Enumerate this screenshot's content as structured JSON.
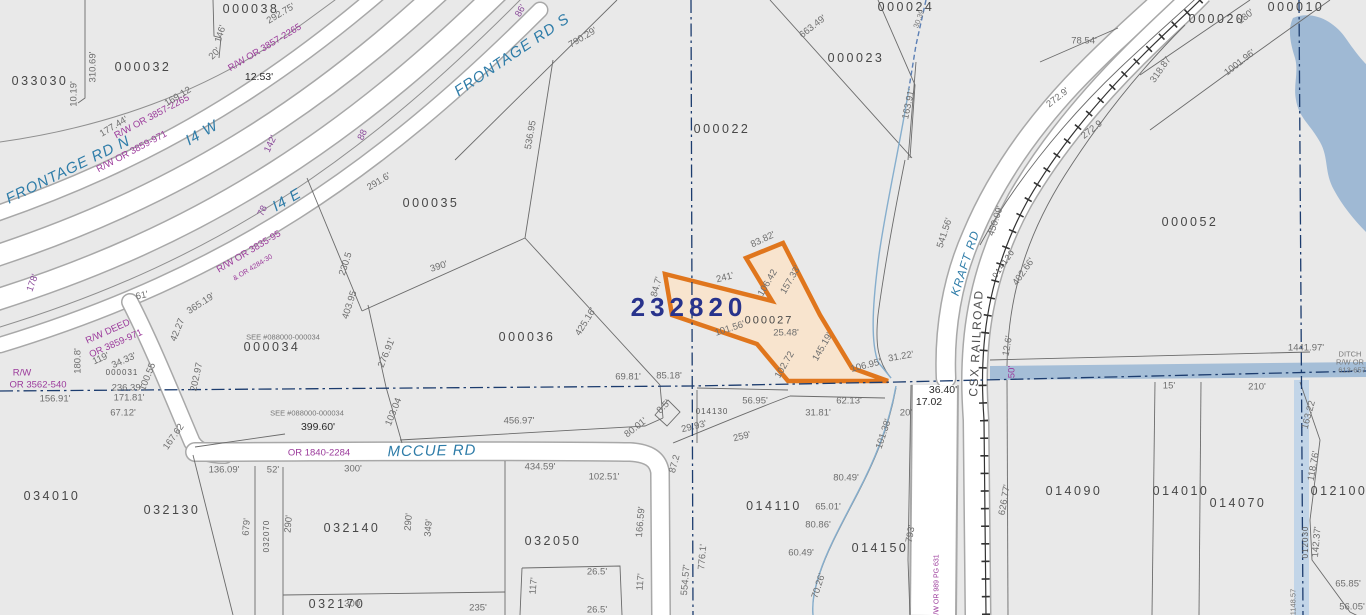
{
  "map": {
    "type": "county-parcel-gis-map",
    "highlight": {
      "id": "232820",
      "parcel": "000027",
      "outline_color": "#e0761d",
      "fill_color": "#f8e4ce"
    },
    "colors": {
      "parcel_fill": "#e9e9e9",
      "road_fill": "#ffffff",
      "road_casing": "#a8a8a8",
      "boundary": "#6b6b6b",
      "section_line": "#1c3c6e",
      "water": "#9fb9d4",
      "stream": "#86aecd",
      "parcel_text": "#474747",
      "dim_text": "#6e6e6e",
      "record_text": "#9b3a9b",
      "road_text": "#2e7ca8",
      "highlight_id_text": "#28338c"
    },
    "roads": [
      "FRONTAGE RD N",
      "I4 W",
      "I4 E",
      "FRONTAGE RD S",
      "MCCUE RD",
      "KRAFT RD"
    ],
    "railroad": "CSX RAILROAD",
    "water_features": [
      "pond",
      "DITCH R/W OR 613-657",
      "stream"
    ]
  },
  "labels": [
    {
      "text": "033030",
      "x": 40,
      "y": 81,
      "r": 0,
      "c": "p"
    },
    {
      "text": "000032",
      "x": 143,
      "y": 67,
      "r": 0,
      "c": "p"
    },
    {
      "text": "000038",
      "x": 251,
      "y": 9,
      "r": 0,
      "c": "p"
    },
    {
      "text": "000035",
      "x": 431,
      "y": 203,
      "r": 0,
      "c": "p"
    },
    {
      "text": "000036",
      "x": 527,
      "y": 337,
      "r": 0,
      "c": "p"
    },
    {
      "text": "000034",
      "x": 272,
      "y": 347,
      "r": 0,
      "c": "p"
    },
    {
      "text": "034010",
      "x": 52,
      "y": 496,
      "r": 0,
      "c": "p"
    },
    {
      "text": "032130",
      "x": 172,
      "y": 510,
      "r": 0,
      "c": "p"
    },
    {
      "text": "032140",
      "x": 352,
      "y": 528,
      "r": 0,
      "c": "p"
    },
    {
      "text": "032050",
      "x": 553,
      "y": 541,
      "r": 0,
      "c": "p"
    },
    {
      "text": "032170",
      "x": 337,
      "y": 604,
      "r": 0,
      "c": "p"
    },
    {
      "text": "000022",
      "x": 722,
      "y": 129,
      "r": 0,
      "c": "p"
    },
    {
      "text": "000023",
      "x": 856,
      "y": 58,
      "r": 0,
      "c": "p"
    },
    {
      "text": "000024",
      "x": 906,
      "y": 7,
      "r": 0,
      "c": "p"
    },
    {
      "text": "000052",
      "x": 1190,
      "y": 222,
      "r": 0,
      "c": "p"
    },
    {
      "text": "000020",
      "x": 1217,
      "y": 19,
      "r": 0,
      "c": "p"
    },
    {
      "text": "000010",
      "x": 1296,
      "y": 7,
      "r": 0,
      "c": "p"
    },
    {
      "text": "014110",
      "x": 774,
      "y": 506,
      "r": 0,
      "c": "p"
    },
    {
      "text": "014150",
      "x": 880,
      "y": 548,
      "r": 0,
      "c": "p"
    },
    {
      "text": "014090",
      "x": 1074,
      "y": 491,
      "r": 0,
      "c": "p"
    },
    {
      "text": "014010",
      "x": 1181,
      "y": 491,
      "r": 0,
      "c": "p"
    },
    {
      "text": "014070",
      "x": 1238,
      "y": 503,
      "r": 0,
      "c": "p"
    },
    {
      "text": "012100",
      "x": 1339,
      "y": 491,
      "r": 0,
      "c": "p"
    },
    {
      "text": "000027",
      "x": 769,
      "y": 321,
      "r": 0,
      "c": "pm"
    },
    {
      "text": "014130",
      "x": 712,
      "y": 412,
      "r": 0,
      "c": "ps"
    },
    {
      "text": "000031",
      "x": 122,
      "y": 373,
      "r": 0,
      "c": "ps"
    },
    {
      "text": "032070",
      "x": 267,
      "y": 536,
      "r": -90,
      "c": "ps"
    },
    {
      "text": "012030",
      "x": 1306,
      "y": 542,
      "r": -90,
      "c": "ps"
    },
    {
      "text": "014120",
      "x": 1004,
      "y": 264,
      "r": -55,
      "c": "ps"
    },
    {
      "text": "232820",
      "x": 689,
      "y": 307,
      "r": 0,
      "c": "big"
    },
    {
      "text": "FRONTAGE RD N",
      "x": 68,
      "y": 170,
      "r": -26,
      "c": "road"
    },
    {
      "text": "FRONTAGE RD S",
      "x": 512,
      "y": 55,
      "r": -34,
      "c": "road"
    },
    {
      "text": "I4 W",
      "x": 202,
      "y": 133,
      "r": -30,
      "c": "road"
    },
    {
      "text": "I4 E",
      "x": 287,
      "y": 200,
      "r": -30,
      "c": "road"
    },
    {
      "text": "MCCUE RD",
      "x": 432,
      "y": 451,
      "r": -1,
      "c": "road"
    },
    {
      "text": "KRAFT RD",
      "x": 965,
      "y": 263,
      "r": -72,
      "c": "roads"
    },
    {
      "text": "CSX RAILROAD",
      "x": 976,
      "y": 343,
      "r": -87,
      "c": "rr"
    },
    {
      "text": "R/W OR 3857-2265",
      "x": 265,
      "y": 48,
      "r": -31,
      "c": "rw"
    },
    {
      "text": "R/W OR 3857-2265",
      "x": 152,
      "y": 117,
      "r": -28,
      "c": "rw"
    },
    {
      "text": "R/W OR 3859-971",
      "x": 132,
      "y": 152,
      "r": -28,
      "c": "rw"
    },
    {
      "text": "R/W OR 3835-95",
      "x": 249,
      "y": 252,
      "r": -31,
      "c": "rw"
    },
    {
      "text": "& OR 4284-30",
      "x": 253,
      "y": 268,
      "r": -31,
      "c": "rws"
    },
    {
      "text": "R/W DEED",
      "x": 108,
      "y": 332,
      "r": -24,
      "c": "rw"
    },
    {
      "text": "OR 3859-971",
      "x": 116,
      "y": 344,
      "r": -24,
      "c": "rw"
    },
    {
      "text": "R/W",
      "x": 22,
      "y": 373,
      "r": 0,
      "c": "rw"
    },
    {
      "text": "OR 3562-540",
      "x": 38,
      "y": 385,
      "r": 0,
      "c": "rw"
    },
    {
      "text": "OR 1840-2284",
      "x": 319,
      "y": 453,
      "r": 0,
      "c": "rw"
    },
    {
      "text": "R/W OR 989 PG 631",
      "x": 937,
      "y": 587,
      "r": -90,
      "c": "rws"
    },
    {
      "text": "50'",
      "x": 1012,
      "y": 372,
      "r": -90,
      "c": "rw"
    },
    {
      "text": "142'",
      "x": 271,
      "y": 144,
      "r": -65,
      "c": "pu"
    },
    {
      "text": "88",
      "x": 363,
      "y": 135,
      "r": -65,
      "c": "pu"
    },
    {
      "text": "78",
      "x": 263,
      "y": 211,
      "r": -65,
      "c": "pu"
    },
    {
      "text": "178'",
      "x": 33,
      "y": 283,
      "r": -70,
      "c": "pu"
    },
    {
      "text": "86'",
      "x": 521,
      "y": 11,
      "r": -60,
      "c": "pu"
    },
    {
      "text": "12.53'",
      "x": 259,
      "y": 77,
      "r": 0,
      "c": "dk"
    },
    {
      "text": "36.40'",
      "x": 943,
      "y": 390,
      "r": 0,
      "c": "dk"
    },
    {
      "text": "17.02",
      "x": 929,
      "y": 402,
      "r": 0,
      "c": "dk"
    },
    {
      "text": "292.75'",
      "x": 281,
      "y": 14,
      "r": -31,
      "c": "d"
    },
    {
      "text": "146'",
      "x": 221,
      "y": 34,
      "r": -72,
      "c": "d"
    },
    {
      "text": "20'",
      "x": 215,
      "y": 54,
      "r": -45,
      "c": "d"
    },
    {
      "text": "310.69'",
      "x": 93,
      "y": 67,
      "r": -90,
      "c": "d"
    },
    {
      "text": "10.19'",
      "x": 74,
      "y": 94,
      "r": -90,
      "c": "d"
    },
    {
      "text": "169.12",
      "x": 178,
      "y": 97,
      "r": -31,
      "c": "d"
    },
    {
      "text": "177.44'",
      "x": 114,
      "y": 127,
      "r": -31,
      "c": "d"
    },
    {
      "text": "291.6'",
      "x": 379,
      "y": 182,
      "r": -31,
      "c": "d"
    },
    {
      "text": "230.5",
      "x": 346,
      "y": 264,
      "r": -72,
      "c": "d"
    },
    {
      "text": "403.95",
      "x": 350,
      "y": 305,
      "r": -72,
      "c": "d"
    },
    {
      "text": "365.19'",
      "x": 201,
      "y": 304,
      "r": -33,
      "c": "d"
    },
    {
      "text": "61'",
      "x": 142,
      "y": 296,
      "r": -12,
      "c": "d"
    },
    {
      "text": "790.29'",
      "x": 583,
      "y": 38,
      "r": -31,
      "c": "d"
    },
    {
      "text": "536.95",
      "x": 531,
      "y": 135,
      "r": -80,
      "c": "d"
    },
    {
      "text": "390'",
      "x": 439,
      "y": 267,
      "r": -18,
      "c": "d"
    },
    {
      "text": "425.16'",
      "x": 586,
      "y": 322,
      "r": -58,
      "c": "d"
    },
    {
      "text": "276.91'",
      "x": 387,
      "y": 353,
      "r": -68,
      "c": "d"
    },
    {
      "text": "103.04",
      "x": 394,
      "y": 412,
      "r": -68,
      "c": "d"
    },
    {
      "text": "167.62",
      "x": 174,
      "y": 437,
      "r": -55,
      "c": "d"
    },
    {
      "text": "119'",
      "x": 101,
      "y": 359,
      "r": -24,
      "c": "d"
    },
    {
      "text": "34.33'",
      "x": 124,
      "y": 361,
      "r": -24,
      "c": "d"
    },
    {
      "text": "100.55",
      "x": 148,
      "y": 377,
      "r": -68,
      "c": "d"
    },
    {
      "text": "236.39'",
      "x": 127,
      "y": 388,
      "r": 0,
      "c": "d"
    },
    {
      "text": "171.81'",
      "x": 129,
      "y": 398,
      "r": 0,
      "c": "d"
    },
    {
      "text": "67.12'",
      "x": 123,
      "y": 413,
      "r": 0,
      "c": "d"
    },
    {
      "text": "202.97",
      "x": 197,
      "y": 377,
      "r": -78,
      "c": "d"
    },
    {
      "text": "42.27",
      "x": 178,
      "y": 330,
      "r": -68,
      "c": "d"
    },
    {
      "text": "SEE #088000-000034",
      "x": 283,
      "y": 337,
      "r": 0,
      "c": "ds"
    },
    {
      "text": "SEE #088000-000034",
      "x": 307,
      "y": 413,
      "r": 0,
      "c": "ds"
    },
    {
      "text": "399.60'",
      "x": 318,
      "y": 427,
      "r": 0,
      "c": "dk"
    },
    {
      "text": "156.91'",
      "x": 55,
      "y": 399,
      "r": 0,
      "c": "d"
    },
    {
      "text": "180.8'",
      "x": 78,
      "y": 361,
      "r": -90,
      "c": "d"
    },
    {
      "text": "663.49'",
      "x": 813,
      "y": 27,
      "r": -38,
      "c": "d"
    },
    {
      "text": "163.91'",
      "x": 909,
      "y": 104,
      "r": -78,
      "c": "d"
    },
    {
      "text": "30.39",
      "x": 919,
      "y": 19,
      "r": -70,
      "c": "ds"
    },
    {
      "text": "78.54'",
      "x": 1084,
      "y": 41,
      "r": 0,
      "c": "d"
    },
    {
      "text": "272.9'",
      "x": 1058,
      "y": 98,
      "r": -38,
      "c": "d"
    },
    {
      "text": "272.9",
      "x": 1092,
      "y": 130,
      "r": -38,
      "c": "d"
    },
    {
      "text": "318.87",
      "x": 1161,
      "y": 70,
      "r": -55,
      "c": "d"
    },
    {
      "text": "541.56'",
      "x": 945,
      "y": 233,
      "r": -72,
      "c": "d"
    },
    {
      "text": "450.09'",
      "x": 996,
      "y": 221,
      "r": -72,
      "c": "d"
    },
    {
      "text": "402.66'",
      "x": 1024,
      "y": 272,
      "r": -55,
      "c": "d"
    },
    {
      "text": "1001.96'",
      "x": 1240,
      "y": 63,
      "r": -38,
      "c": "d"
    },
    {
      "text": "180'",
      "x": 1246,
      "y": 17,
      "r": -38,
      "c": "d"
    },
    {
      "text": "626.77'",
      "x": 1005,
      "y": 500,
      "r": -80,
      "c": "d"
    },
    {
      "text": "793'",
      "x": 911,
      "y": 534,
      "r": -80,
      "c": "d"
    },
    {
      "text": "1441.97'",
      "x": 1306,
      "y": 348,
      "r": 0,
      "c": "d"
    },
    {
      "text": "DITCH",
      "x": 1350,
      "y": 354,
      "r": 0,
      "c": "ds"
    },
    {
      "text": "R/W OR",
      "x": 1350,
      "y": 362,
      "r": 0,
      "c": "ds"
    },
    {
      "text": "613-657",
      "x": 1352,
      "y": 370,
      "r": 0,
      "c": "ds"
    },
    {
      "text": "15'",
      "x": 1169,
      "y": 386,
      "r": 0,
      "c": "d"
    },
    {
      "text": "210'",
      "x": 1257,
      "y": 387,
      "r": 0,
      "c": "d"
    },
    {
      "text": "163.22",
      "x": 1309,
      "y": 415,
      "r": -75,
      "c": "d"
    },
    {
      "text": "118.76'",
      "x": 1314,
      "y": 466,
      "r": -80,
      "c": "d"
    },
    {
      "text": "142.37'",
      "x": 1317,
      "y": 542,
      "r": -85,
      "c": "d"
    },
    {
      "text": "65.85'",
      "x": 1348,
      "y": 584,
      "r": 0,
      "c": "d"
    },
    {
      "text": "56.05'",
      "x": 1352,
      "y": 607,
      "r": 0,
      "c": "d"
    },
    {
      "text": "1148.57",
      "x": 1293,
      "y": 602,
      "r": -90,
      "c": "ds"
    },
    {
      "text": "12.6'",
      "x": 1008,
      "y": 346,
      "r": -80,
      "c": "d"
    },
    {
      "text": "31.22'",
      "x": 901,
      "y": 357,
      "r": -10,
      "c": "d"
    },
    {
      "text": "106.95'",
      "x": 866,
      "y": 366,
      "r": -14,
      "c": "d"
    },
    {
      "text": "20'",
      "x": 906,
      "y": 413,
      "r": 0,
      "c": "d"
    },
    {
      "text": "101.38'",
      "x": 884,
      "y": 434,
      "r": -72,
      "c": "d"
    },
    {
      "text": "80.49'",
      "x": 846,
      "y": 478,
      "r": 0,
      "c": "d"
    },
    {
      "text": "65.01'",
      "x": 828,
      "y": 507,
      "r": 0,
      "c": "d"
    },
    {
      "text": "80.86'",
      "x": 818,
      "y": 525,
      "r": 0,
      "c": "d"
    },
    {
      "text": "60.49'",
      "x": 801,
      "y": 553,
      "r": 0,
      "c": "d"
    },
    {
      "text": "70.26'",
      "x": 819,
      "y": 586,
      "r": -72,
      "c": "d"
    },
    {
      "text": "56.95'",
      "x": 755,
      "y": 401,
      "r": 0,
      "c": "d"
    },
    {
      "text": "62.13'",
      "x": 849,
      "y": 401,
      "r": 0,
      "c": "d"
    },
    {
      "text": "31.81'",
      "x": 818,
      "y": 413,
      "r": 0,
      "c": "d"
    },
    {
      "text": "29.93'",
      "x": 694,
      "y": 427,
      "r": -14,
      "c": "d"
    },
    {
      "text": "259'",
      "x": 742,
      "y": 437,
      "r": -14,
      "c": "d"
    },
    {
      "text": "8.5'",
      "x": 664,
      "y": 407,
      "r": -45,
      "c": "d"
    },
    {
      "text": "87.2",
      "x": 675,
      "y": 464,
      "r": -75,
      "c": "d"
    },
    {
      "text": "69.81'",
      "x": 628,
      "y": 377,
      "r": 0,
      "c": "d"
    },
    {
      "text": "85.18'",
      "x": 669,
      "y": 376,
      "r": 0,
      "c": "d"
    },
    {
      "text": "456.97'",
      "x": 519,
      "y": 421,
      "r": 0,
      "c": "d"
    },
    {
      "text": "80.01'",
      "x": 636,
      "y": 428,
      "r": -38,
      "c": "d"
    },
    {
      "text": "136.09'",
      "x": 224,
      "y": 470,
      "r": 0,
      "c": "d"
    },
    {
      "text": "52'",
      "x": 273,
      "y": 470,
      "r": 0,
      "c": "d"
    },
    {
      "text": "300'",
      "x": 353,
      "y": 469,
      "r": 0,
      "c": "d"
    },
    {
      "text": "434.59'",
      "x": 540,
      "y": 467,
      "r": 0,
      "c": "d"
    },
    {
      "text": "102.51'",
      "x": 604,
      "y": 477,
      "r": 0,
      "c": "d"
    },
    {
      "text": "166.59'",
      "x": 641,
      "y": 522,
      "r": -85,
      "c": "d"
    },
    {
      "text": "554.57'",
      "x": 686,
      "y": 580,
      "r": -85,
      "c": "d"
    },
    {
      "text": "776.1'",
      "x": 703,
      "y": 557,
      "r": -85,
      "c": "d"
    },
    {
      "text": "679'",
      "x": 247,
      "y": 527,
      "r": -85,
      "c": "d"
    },
    {
      "text": "290'",
      "x": 289,
      "y": 524,
      "r": -85,
      "c": "d"
    },
    {
      "text": "290'",
      "x": 409,
      "y": 522,
      "r": -85,
      "c": "d"
    },
    {
      "text": "349'",
      "x": 429,
      "y": 528,
      "r": -85,
      "c": "d"
    },
    {
      "text": "300'",
      "x": 353,
      "y": 604,
      "r": 0,
      "c": "d"
    },
    {
      "text": "235'",
      "x": 478,
      "y": 608,
      "r": 0,
      "c": "d"
    },
    {
      "text": "117'",
      "x": 534,
      "y": 586,
      "r": -85,
      "c": "d"
    },
    {
      "text": "26.5'",
      "x": 597,
      "y": 572,
      "r": 0,
      "c": "d"
    },
    {
      "text": "26.5'",
      "x": 597,
      "y": 610,
      "r": 0,
      "c": "d"
    },
    {
      "text": "117'",
      "x": 641,
      "y": 582,
      "r": -85,
      "c": "d"
    },
    {
      "text": "241'",
      "x": 725,
      "y": 278,
      "r": -14,
      "c": "d"
    },
    {
      "text": "83.82'",
      "x": 763,
      "y": 240,
      "r": -25,
      "c": "d"
    },
    {
      "text": "106.42",
      "x": 768,
      "y": 283,
      "r": -60,
      "c": "d"
    },
    {
      "text": "157.33'",
      "x": 791,
      "y": 280,
      "r": -60,
      "c": "d"
    },
    {
      "text": "145.19'",
      "x": 823,
      "y": 347,
      "r": -60,
      "c": "d"
    },
    {
      "text": "101.56'",
      "x": 730,
      "y": 329,
      "r": -18,
      "c": "d"
    },
    {
      "text": "102.72",
      "x": 785,
      "y": 365,
      "r": -60,
      "c": "d"
    },
    {
      "text": "25.48'",
      "x": 786,
      "y": 333,
      "r": 0,
      "c": "d"
    },
    {
      "text": "84.7'",
      "x": 657,
      "y": 287,
      "r": -75,
      "c": "d"
    }
  ]
}
